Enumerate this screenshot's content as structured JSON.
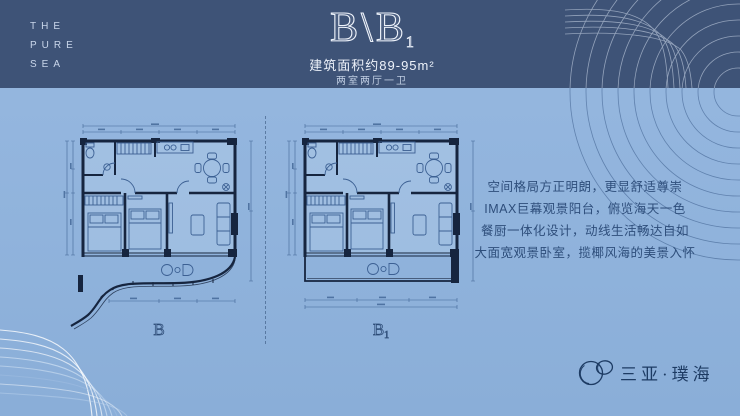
{
  "brand": {
    "lines": [
      "THE",
      "PURE",
      "SEA"
    ]
  },
  "header": {
    "unit_main": "B",
    "separator": "\\",
    "unit_secondary": "B",
    "unit_secondary_sub": "1",
    "area_text": "建筑面积约89-95m²",
    "layout_text": "两室两厅一卫"
  },
  "plans": [
    {
      "label": "B",
      "sub": ""
    },
    {
      "label": "B",
      "sub": "1"
    }
  ],
  "description": {
    "lines": [
      "空间格局方正明朗，更显舒适尊崇",
      "IMAX巨幕观景阳台，俯览海天一色",
      "餐厨一体化设计，动线生活畅达自如",
      "大面宽观景卧室，揽椰风海的美景入怀"
    ]
  },
  "footer": {
    "logo_text": "三亚·璞海"
  },
  "colors": {
    "band": "#3e5377",
    "background_top": "#97b8e0",
    "background_bottom": "#8aaed8",
    "ink": "#2e4e7b",
    "wall": "#16253f",
    "furniture_line": "#3c6093",
    "title_outline": "#eef3fb",
    "logo": "#1d3b63"
  }
}
